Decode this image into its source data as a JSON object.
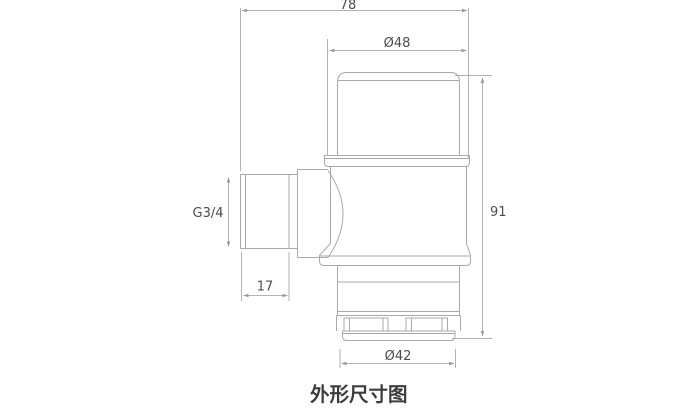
{
  "drawing": {
    "caption": "外形尺寸图",
    "dims": {
      "overall_width": "78",
      "cap_diameter": "Ø48",
      "overall_height": "91",
      "inlet_thread": "G3/4",
      "thread_length": "17",
      "bottom_diameter": "Ø42"
    },
    "colors": {
      "outline": "#a9a9a9",
      "dimension_line": "#b3b3b3",
      "arrow": "#9a9a9a",
      "dimension_text": "#4d4d4d",
      "caption_text": "#3c3c3c",
      "background": "#ffffff"
    }
  }
}
